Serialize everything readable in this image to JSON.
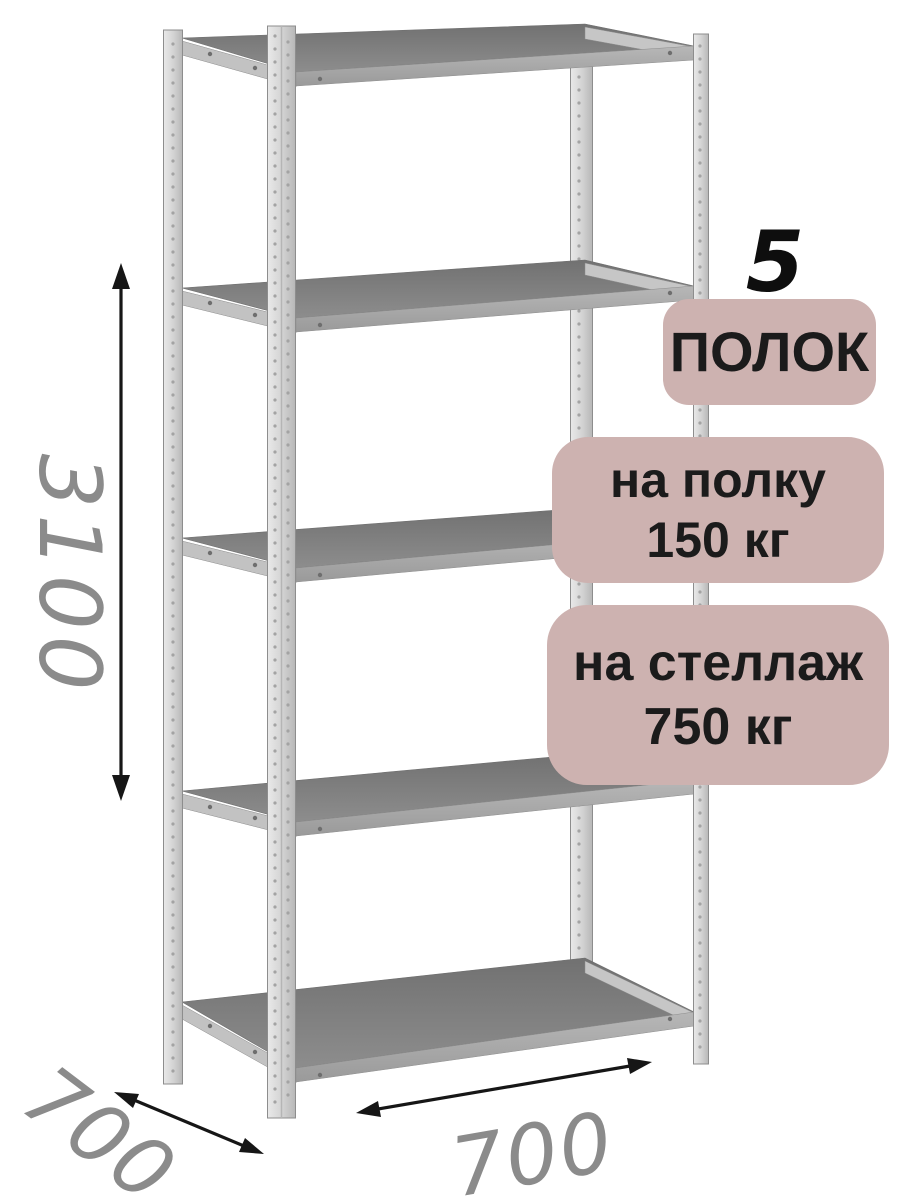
{
  "badges": {
    "shelf_count": {
      "number": "5",
      "label": "ПОЛОК"
    },
    "shelf_load": {
      "line1": "на полку",
      "line2": "150 кг"
    },
    "rack_load": {
      "line1": "на стеллаж",
      "line2": "750 кг"
    }
  },
  "dimensions": {
    "height_mm": "3100",
    "depth_mm": "700",
    "width_mm": "700"
  },
  "rack": {
    "shelves_count": 5,
    "posts_count": 4
  },
  "colors": {
    "background": "#ffffff",
    "badge_background": "#cdb2b0",
    "badge_text": "#1b1b1b",
    "dimension_text": "#8b8b8b",
    "arrow": "#161616",
    "shelf_surface_gray": "#808080",
    "shelf_edge_gray": "#a8a8a8",
    "post_gray": "#d2d2d2"
  }
}
